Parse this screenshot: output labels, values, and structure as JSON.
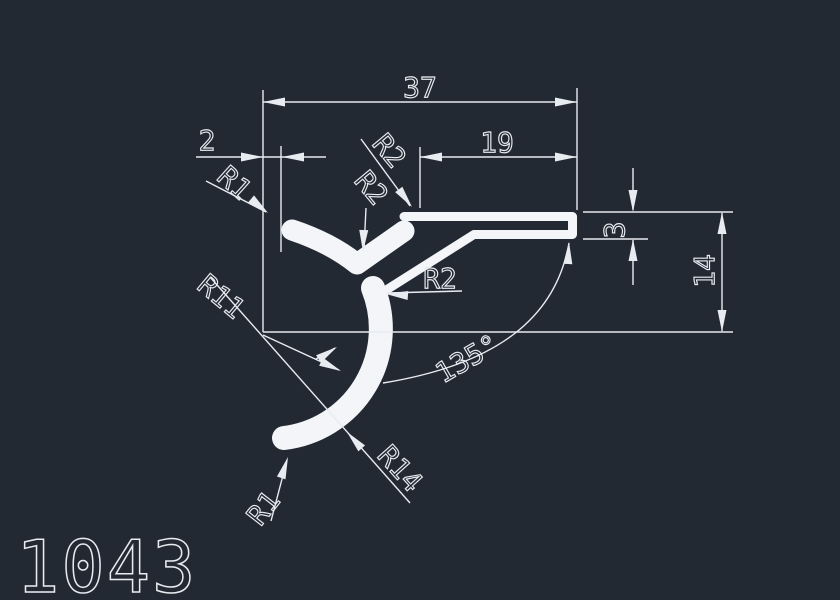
{
  "part_label": "1043",
  "colors": {
    "background": "#232933",
    "line_color": "#e8ebf0",
    "profile_color": "#f3f5f8"
  },
  "dimensions": {
    "total_width": "37",
    "tip_offset": "2",
    "flange_length": "19",
    "thickness": "3",
    "height": "14",
    "angle": "135°"
  },
  "radii": {
    "top_tip": "R1",
    "top_corner": "R2",
    "valley": "R2",
    "inner_corner": "R2",
    "arc_inner": "R11",
    "arc_outer": "R14",
    "bottom_tip": "R1"
  }
}
